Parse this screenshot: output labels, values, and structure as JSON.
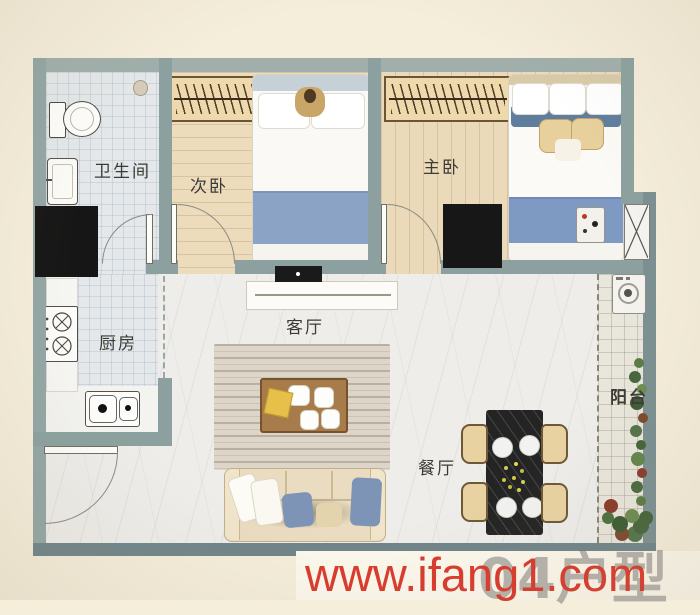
{
  "plan": {
    "type": "apartment-floor-plan",
    "wall_color": "#8ca19f",
    "background_color": "#f5eedb",
    "rooms": {
      "bathroom": {
        "label": "卫生间"
      },
      "secondary_bedroom": {
        "label": "次卧"
      },
      "master_bedroom": {
        "label": "主卧"
      },
      "kitchen": {
        "label": "厨房"
      },
      "living_room": {
        "label": "客厅"
      },
      "dining_room": {
        "label": "餐厅"
      },
      "balcony": {
        "label": "阳台"
      }
    }
  },
  "watermark": {
    "site_url": "www.ifang1.com",
    "unit_type": "04户型",
    "url_color": "#da3a2c",
    "unit_color": "#7a7a7a"
  }
}
